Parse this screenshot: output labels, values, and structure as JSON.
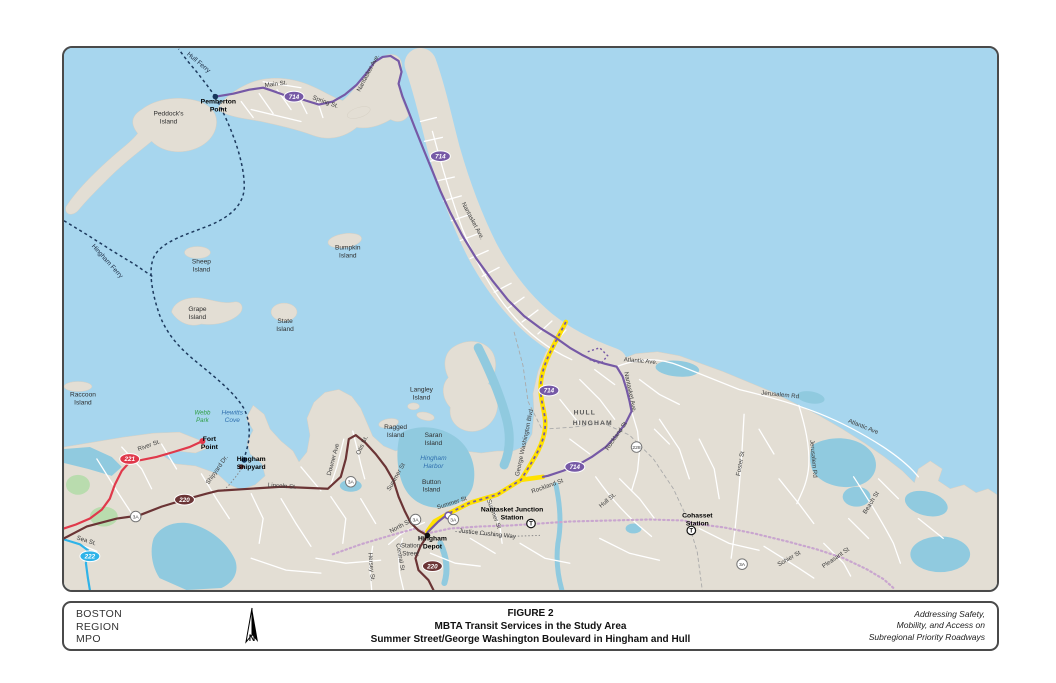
{
  "page": {
    "figure_label": "FIGURE 2",
    "title_line1": "MBTA Transit Services in the Study Area",
    "title_line2": "Summer Street/George Washington Boulevard in Hingham and Hull",
    "org": [
      "BOSTON",
      "REGION",
      "MPO"
    ],
    "tagline": [
      "Addressing Safety,",
      "Mobility, and Access on",
      "Subregional Priority Roadways"
    ],
    "compass_label": "N"
  },
  "map": {
    "colors": {
      "water": "#A7D6EE",
      "land": "#E3DED4",
      "inland_water": "#90CADF",
      "park_green": "#B9DCAE",
      "route_714": "#7659A6",
      "route_220": "#6B3435",
      "route_221": "#E0394B",
      "route_222": "#2FB3E8",
      "study_corridor": "#FFE100",
      "commuter_rail": "#C9A6CF",
      "ferry": "#1D3A5E"
    },
    "labels": [
      {
        "t": "Hull Ferry",
        "x": 196,
        "y": 62,
        "r": 40,
        "c": "fer"
      },
      {
        "t": "Pemberton",
        "x": 217,
        "y": 102,
        "r": 0,
        "c": "b",
        "a": "s"
      },
      {
        "t": "Point",
        "x": 217,
        "y": 110,
        "r": 0,
        "c": "b",
        "a": "s"
      },
      {
        "t": "Peddock's",
        "x": 167,
        "y": 114,
        "r": 0,
        "c": "isl"
      },
      {
        "t": "Island",
        "x": 167,
        "y": 122,
        "r": 0,
        "c": "isl"
      },
      {
        "t": "Main St.",
        "x": 275,
        "y": 84,
        "r": -7,
        "c": "road"
      },
      {
        "t": "Spring St.",
        "x": 324,
        "y": 102,
        "r": 20,
        "c": "road"
      },
      {
        "t": "Nantasket Ave.",
        "x": 369,
        "y": 72,
        "r": -62,
        "c": "road"
      },
      {
        "t": "Nantasket Ave.",
        "x": 471,
        "y": 221,
        "r": 62,
        "c": "road"
      },
      {
        "t": "Bumpkin",
        "x": 347,
        "y": 249,
        "r": 0,
        "c": "isl"
      },
      {
        "t": "Island",
        "x": 347,
        "y": 257,
        "r": 0,
        "c": "isl"
      },
      {
        "t": "Sheep",
        "x": 200,
        "y": 263,
        "r": 0,
        "c": "isl"
      },
      {
        "t": "Island",
        "x": 200,
        "y": 271,
        "r": 0,
        "c": "isl"
      },
      {
        "t": "Grape",
        "x": 196,
        "y": 311,
        "r": 0,
        "c": "isl"
      },
      {
        "t": "Island",
        "x": 196,
        "y": 319,
        "r": 0,
        "c": "isl"
      },
      {
        "t": "State",
        "x": 284,
        "y": 323,
        "r": 0,
        "c": "isl"
      },
      {
        "t": "Island",
        "x": 284,
        "y": 331,
        "r": 0,
        "c": "isl"
      },
      {
        "t": "Hingham Ferry",
        "x": 104,
        "y": 262,
        "r": 48,
        "c": "fer"
      },
      {
        "t": "Raccoon",
        "x": 81,
        "y": 397,
        "r": 0,
        "c": "isl"
      },
      {
        "t": "Island",
        "x": 81,
        "y": 405,
        "r": 0,
        "c": "isl"
      },
      {
        "t": "Webb",
        "x": 201,
        "y": 415,
        "r": 0,
        "c": "park"
      },
      {
        "t": "Park",
        "x": 201,
        "y": 423,
        "r": 0,
        "c": "park"
      },
      {
        "t": "Hewitts",
        "x": 231,
        "y": 415,
        "r": 0,
        "c": "wat"
      },
      {
        "t": "Cove",
        "x": 231,
        "y": 423,
        "r": 0,
        "c": "wat"
      },
      {
        "t": "Langley",
        "x": 421,
        "y": 392,
        "r": 0,
        "c": "isl"
      },
      {
        "t": "Island",
        "x": 421,
        "y": 400,
        "r": 0,
        "c": "isl"
      },
      {
        "t": "Ragged",
        "x": 395,
        "y": 430,
        "r": 0,
        "c": "isl"
      },
      {
        "t": "Island",
        "x": 395,
        "y": 438,
        "r": 0,
        "c": "isl"
      },
      {
        "t": "Saran",
        "x": 433,
        "y": 438,
        "r": 0,
        "c": "isl"
      },
      {
        "t": "Island",
        "x": 433,
        "y": 446,
        "r": 0,
        "c": "isl"
      },
      {
        "t": "Hingham",
        "x": 433,
        "y": 461,
        "r": 0,
        "c": "wat"
      },
      {
        "t": "Harbor",
        "x": 433,
        "y": 469,
        "r": 0,
        "c": "wat"
      },
      {
        "t": "Button",
        "x": 431,
        "y": 485,
        "r": 0,
        "c": "isl"
      },
      {
        "t": "Island",
        "x": 431,
        "y": 493,
        "r": 0,
        "c": "isl"
      },
      {
        "t": "Fort",
        "x": 208,
        "y": 442,
        "r": 0,
        "c": "b",
        "a": "s"
      },
      {
        "t": "Point",
        "x": 208,
        "y": 450,
        "r": 0,
        "c": "b",
        "a": "s"
      },
      {
        "t": "River St.",
        "x": 148,
        "y": 448,
        "r": -20,
        "c": "road"
      },
      {
        "t": "Hingham",
        "x": 250,
        "y": 462,
        "r": 0,
        "c": "b",
        "a": "s"
      },
      {
        "t": "Shipyard",
        "x": 250,
        "y": 470,
        "r": 0,
        "c": "b",
        "a": "s"
      },
      {
        "t": "Shipyard Dr.",
        "x": 217,
        "y": 472,
        "r": -55,
        "c": "road"
      },
      {
        "t": "Lincoln St.",
        "x": 281,
        "y": 489,
        "r": 4,
        "c": "road"
      },
      {
        "t": "Sea St.",
        "x": 84,
        "y": 544,
        "r": 18,
        "c": "road"
      },
      {
        "t": "Downer Ave",
        "x": 334,
        "y": 461,
        "r": -75,
        "c": "road"
      },
      {
        "t": "Otis St.",
        "x": 363,
        "y": 447,
        "r": -65,
        "c": "road"
      },
      {
        "t": "Summer St",
        "x": 397,
        "y": 479,
        "r": -60,
        "c": "road"
      },
      {
        "t": "North St.",
        "x": 401,
        "y": 529,
        "r": -28,
        "c": "road"
      },
      {
        "t": "Central St",
        "x": 398,
        "y": 559,
        "r": 80,
        "c": "road"
      },
      {
        "t": "Hersey St.",
        "x": 369,
        "y": 569,
        "r": 85,
        "c": "road"
      },
      {
        "t": "Station",
        "x": 410,
        "y": 549,
        "r": 0,
        "c": "road"
      },
      {
        "t": "Street",
        "x": 410,
        "y": 557,
        "r": 0,
        "c": "road"
      },
      {
        "t": "Hingham",
        "x": 432,
        "y": 542,
        "r": 0,
        "c": "b",
        "a": "s"
      },
      {
        "t": "Depot",
        "x": 432,
        "y": 550,
        "r": 0,
        "c": "b",
        "a": "s"
      },
      {
        "t": "Summer St",
        "x": 452,
        "y": 506,
        "r": -18,
        "c": "road"
      },
      {
        "t": "Summer St",
        "x": 492,
        "y": 516,
        "r": 70,
        "c": "road"
      },
      {
        "t": "Justice Cushing Way",
        "x": 487,
        "y": 537,
        "r": 6,
        "c": "road"
      },
      {
        "t": "Nantasket Junction",
        "x": 512,
        "y": 513,
        "r": 0,
        "c": "b",
        "a": "s"
      },
      {
        "t": "Station",
        "x": 512,
        "y": 521,
        "r": 0,
        "c": "b",
        "a": "s"
      },
      {
        "t": "Rockland St",
        "x": 548,
        "y": 489,
        "r": -20,
        "c": "road"
      },
      {
        "t": "George Washington Blvd",
        "x": 526,
        "y": 444,
        "r": -78,
        "c": "road"
      },
      {
        "t": "HULL",
        "x": 585,
        "y": 415,
        "r": 0,
        "c": "town"
      },
      {
        "t": "HINGHAM",
        "x": 593,
        "y": 426,
        "r": 0,
        "c": "town"
      },
      {
        "t": "Rockland St",
        "x": 618,
        "y": 438,
        "r": -55,
        "c": "road"
      },
      {
        "t": "Nantasket Ave.",
        "x": 629,
        "y": 393,
        "r": 78,
        "c": "road"
      },
      {
        "t": "Atlantic Ave.",
        "x": 641,
        "y": 363,
        "r": 5,
        "c": "road"
      },
      {
        "t": "Jerusalem Rd",
        "x": 781,
        "y": 397,
        "r": 6,
        "c": "road"
      },
      {
        "t": "Atlantic Ave",
        "x": 864,
        "y": 429,
        "r": 22,
        "c": "road"
      },
      {
        "t": "Jerusalem Rd",
        "x": 813,
        "y": 460,
        "r": 85,
        "c": "road"
      },
      {
        "t": "Foster St",
        "x": 743,
        "y": 465,
        "r": -80,
        "c": "road"
      },
      {
        "t": "Beach St",
        "x": 874,
        "y": 505,
        "r": -58,
        "c": "road"
      },
      {
        "t": "Hull St.",
        "x": 609,
        "y": 503,
        "r": -40,
        "c": "road"
      },
      {
        "t": "Cohasset",
        "x": 698,
        "y": 519,
        "r": 0,
        "c": "b",
        "a": "s"
      },
      {
        "t": "Station",
        "x": 698,
        "y": 527,
        "r": 0,
        "c": "b",
        "a": "s"
      },
      {
        "t": "Sohier St",
        "x": 791,
        "y": 562,
        "r": -30,
        "c": "road"
      },
      {
        "t": "Pleasant St",
        "x": 838,
        "y": 561,
        "r": -35,
        "c": "road"
      }
    ],
    "route_markers": [
      {
        "t": "714",
        "x": 293,
        "y": 95,
        "k": "route_714"
      },
      {
        "t": "714",
        "x": 440,
        "y": 155,
        "k": "route_714"
      },
      {
        "t": "714",
        "x": 549,
        "y": 391,
        "k": "route_714"
      },
      {
        "t": "714",
        "x": 575,
        "y": 468,
        "k": "route_714"
      },
      {
        "t": "220",
        "x": 183,
        "y": 501,
        "k": "route_220"
      },
      {
        "t": "220",
        "x": 432,
        "y": 568,
        "k": "route_220"
      },
      {
        "t": "221",
        "x": 128,
        "y": 460,
        "k": "route_221"
      },
      {
        "t": "222",
        "x": 88,
        "y": 558,
        "k": "route_222"
      }
    ],
    "shields": [
      {
        "t": "3A",
        "x": 134,
        "y": 518
      },
      {
        "t": "3A",
        "x": 350,
        "y": 483
      },
      {
        "t": "3A",
        "x": 415,
        "y": 521
      },
      {
        "t": "3A",
        "x": 453,
        "y": 521
      },
      {
        "t": "3A",
        "x": 743,
        "y": 566
      },
      {
        "t": "228",
        "x": 637,
        "y": 448
      }
    ],
    "t_stations": [
      {
        "x": 531,
        "y": 525
      },
      {
        "x": 692,
        "y": 532
      }
    ]
  }
}
